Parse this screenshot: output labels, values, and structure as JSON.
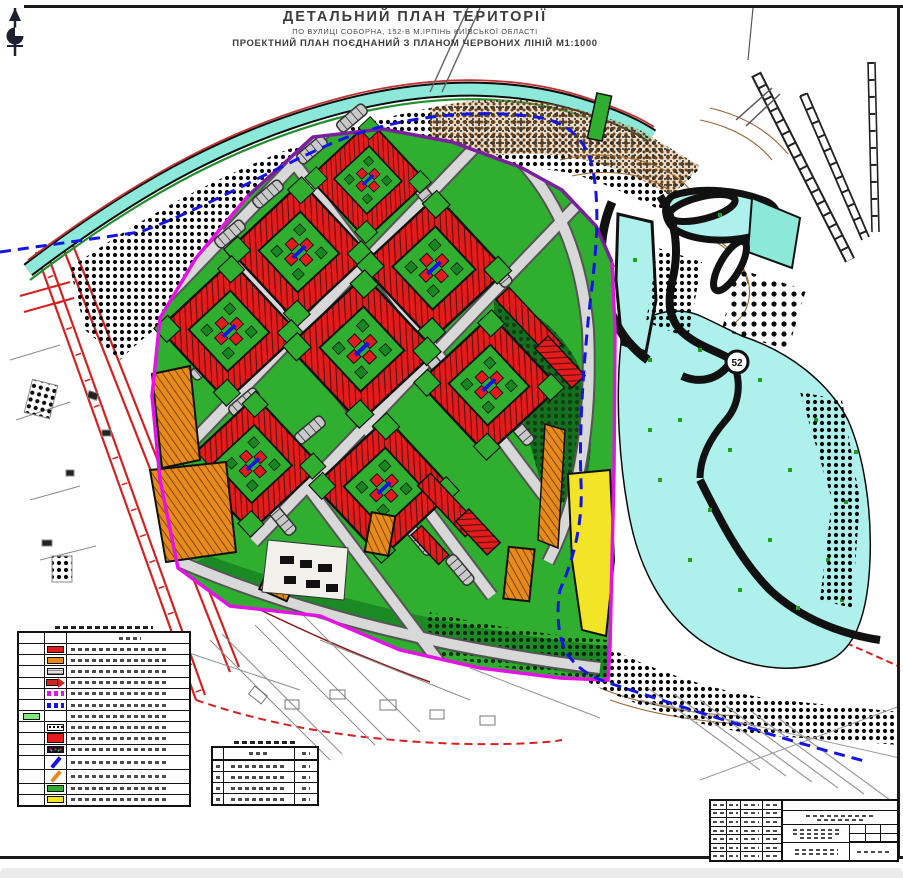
{
  "page": {
    "title_line1": "ДЕТАЛЬНИЙ ПЛАН ТЕРИТОРІЇ",
    "title_line2": "ПО ВУЛИЦІ СОБОРНА, 152-В М.ІРПІНЬ КИЇВСЬКОЇ ОБЛАСТІ",
    "title_line3": "ПРОЕКТНИЙ ПЛАН ПОЄДНАНИЙ З ПЛАНОМ ЧЕРВОНИХ ЛІНІЙ  М1:1000"
  },
  "map": {
    "scale": "М1:1000",
    "label_52": "52",
    "palette": {
      "building_red": "#e41b1b",
      "greenery": "#2fae2f",
      "dark_greenery": "#15701d",
      "orange_building": "#e8891c",
      "yellow_zone": "#f2e427",
      "water_cyan": "#aef0ec",
      "teal_road": "#8ce8d8",
      "boundary_magenta": "#e512e5",
      "boundary_purple": "#7a1f9e",
      "blue_dashed_line": "#1414e6",
      "red_line": "#d42222",
      "contour_brown": "#9a6530",
      "ink_black": "#111111"
    }
  },
  "legend": {
    "title_legible": false,
    "items": [
      {
        "name": "legend-header",
        "style": "header",
        "color": "",
        "label_legible": false
      },
      {
        "name": "red-fill-swatch",
        "style": "fill",
        "color": "#e41b1b",
        "label_legible": false
      },
      {
        "name": "orange-fill-swatch",
        "style": "fill",
        "color": "#e8891c",
        "label_legible": false
      },
      {
        "name": "gray-hatch-swatch",
        "style": "hatch",
        "color": "#9a9a9a",
        "label_legible": false
      },
      {
        "name": "red-line-arrow-swatch",
        "style": "band-arrow",
        "color": "#d42222",
        "label_legible": false
      },
      {
        "name": "magenta-dashed-swatch",
        "style": "dashed",
        "color": "#e512e5",
        "label_legible": false
      },
      {
        "name": "blue-dashed-swatch",
        "style": "dashed",
        "color": "#1414e6",
        "label_legible": false
      },
      {
        "name": "light-green-fill-swatch",
        "style": "fill",
        "color": "#7ee87e",
        "col": "a",
        "label_legible": false
      },
      {
        "name": "black-stipple-swatch",
        "style": "stipple",
        "color": "#111111",
        "label_legible": false
      },
      {
        "name": "red-fill-large-swatch",
        "style": "fill-tall",
        "color": "#e41b1b",
        "label_legible": false
      },
      {
        "name": "dark-mixed-swatch",
        "style": "dark",
        "color": "#14142e",
        "label_legible": false
      },
      {
        "name": "blue-arrow-swatch",
        "style": "arrow-diag",
        "color": "#1414e6",
        "label_legible": false
      },
      {
        "name": "orange-arrow-swatch",
        "style": "arrow-diag",
        "color": "#e8891c",
        "label_legible": false
      },
      {
        "name": "green-fill-swatch",
        "style": "fill",
        "color": "#2fae2f",
        "label_legible": false
      },
      {
        "name": "yellow-fill-swatch",
        "style": "fill",
        "color": "#f2e427",
        "label_legible": false
      }
    ]
  },
  "aux_table": {
    "legible": false,
    "columns": 3,
    "data_rows": 4
  },
  "title_block": {
    "legible": false,
    "left_grid_rows": 7
  }
}
